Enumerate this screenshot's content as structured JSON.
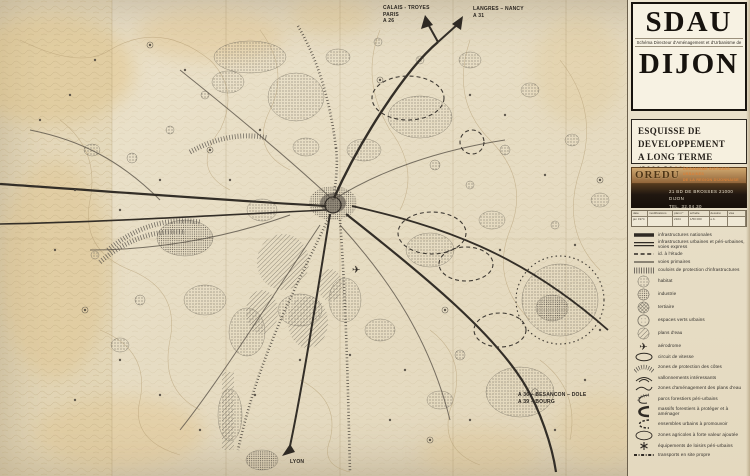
{
  "colors": {
    "paper": "#e8dfc8",
    "ink": "#2f2a24",
    "stipple_gray": "#6f6a5e",
    "oredu_orange": "#d8813a",
    "band_brown": "#53391e",
    "band_dark": "#1f1710",
    "term_accent": "#c06a28"
  },
  "title_block": {
    "acronym": "SDAU",
    "subtitle": "Schéma Directeur d'Aménagement et d'Urbanisme de",
    "city": "DIJON"
  },
  "subtitle_block": {
    "line1": "ESQUISSE DE",
    "line2": "DEVELOPPEMENT",
    "line3_prefix": "A LONG TERME (2000.20",
    "line3_suffix": "10)"
  },
  "agency": {
    "logo": "OREDU",
    "name_line1": "ORGANISME D'ETUDES URBAINES",
    "name_line2": "DE LA REGION DIJONNAISE",
    "address_line1": "21 BD DE BROSSES  21000 DIJON",
    "address_line2": "TEL. 32.04.30"
  },
  "drawing_table": {
    "headers": [
      "date",
      "modifications",
      "plan n°",
      "échelle",
      "dessiné",
      "visa"
    ],
    "row": [
      "jan 1974",
      "",
      "2104",
      "1/50 000",
      "e.b.",
      ""
    ]
  },
  "map_labels": {
    "nw": {
      "line1": "CALAIS - TROYES",
      "line2": "PARIS",
      "line3": "A 26"
    },
    "ne": {
      "line1": "LANGRES – NANCY",
      "line2": "A 31"
    },
    "se": {
      "line1": "A 36 – BESANCON – DOLE",
      "line2": "A 39 – BOURG"
    },
    "s": {
      "line1": "LYON"
    }
  },
  "legend": {
    "items": [
      {
        "symbol": "line-thick",
        "icon": "national-infrastructure-line-icon",
        "label": "infrastructures nationales"
      },
      {
        "symbol": "line-double",
        "icon": "urban-infrastructure-line-icon",
        "label": "infrastructures urbaines et péri-urbaines, voies express"
      },
      {
        "symbol": "line-dashed",
        "icon": "planned-road-dashed-line-icon",
        "label": "id. à l'étude"
      },
      {
        "symbol": "line-thin",
        "icon": "primary-road-line-icon",
        "label": "voies primaires"
      },
      {
        "symbol": "band-hatch",
        "icon": "protection-corridor-band-icon",
        "label": "couloirs de protection d'infrastructures"
      },
      {
        "symbol": "circle-stipple",
        "icon": "housing-stipple-circle-icon",
        "label": "habitat"
      },
      {
        "symbol": "circle-stipple-dense",
        "icon": "industry-stipple-circle-icon",
        "label": "industrie"
      },
      {
        "symbol": "circle-crosshatch",
        "icon": "tertiary-crosshatch-circle-icon",
        "label": "tertiaire"
      },
      {
        "symbol": "circle-outline-dots",
        "icon": "green-space-circle-icon",
        "label": "espaces verts urbains"
      },
      {
        "symbol": "circle-hatch",
        "icon": "water-plane-circle-icon",
        "label": "plans d'eau"
      },
      {
        "symbol": "plane",
        "icon": "airplane-icon",
        "label": "aérodrome"
      },
      {
        "symbol": "oval-outline",
        "icon": "race-circuit-oval-icon",
        "label": "circuit de vitesse"
      },
      {
        "symbol": "hachure-fan",
        "icon": "slope-protection-hachure-icon",
        "label": "zones de protection des côtes"
      },
      {
        "symbol": "curves",
        "icon": "rolling-hills-curves-icon",
        "label": "vallonnements intéressants"
      },
      {
        "symbol": "arc-open",
        "icon": "water-development-arc-icon",
        "label": "zones d'aménagement des plans d'eau"
      },
      {
        "symbol": "arc-forest",
        "icon": "periurban-forest-park-arc-icon",
        "label": "parcs forestiers péri-urbains"
      },
      {
        "symbol": "arc-thick",
        "icon": "forest-massif-arc-icon",
        "label": "massifs forestiers à protéger et à aménager"
      },
      {
        "symbol": "arc-dashed",
        "icon": "urban-ensemble-dashed-arc-icon",
        "label": "ensembles urbains à promouvoir"
      },
      {
        "symbol": "ellipse-outline",
        "icon": "agricultural-zone-ellipse-icon",
        "label": "zones agricoles à forte valeur ajoutée"
      },
      {
        "symbol": "asterisk",
        "icon": "leisure-facility-asterisk-icon",
        "label": "équipements de loisirs péri-urbains"
      },
      {
        "symbol": "line-dashdot",
        "icon": "transit-dashdot-line-icon",
        "label": "transports en site propre"
      }
    ]
  }
}
